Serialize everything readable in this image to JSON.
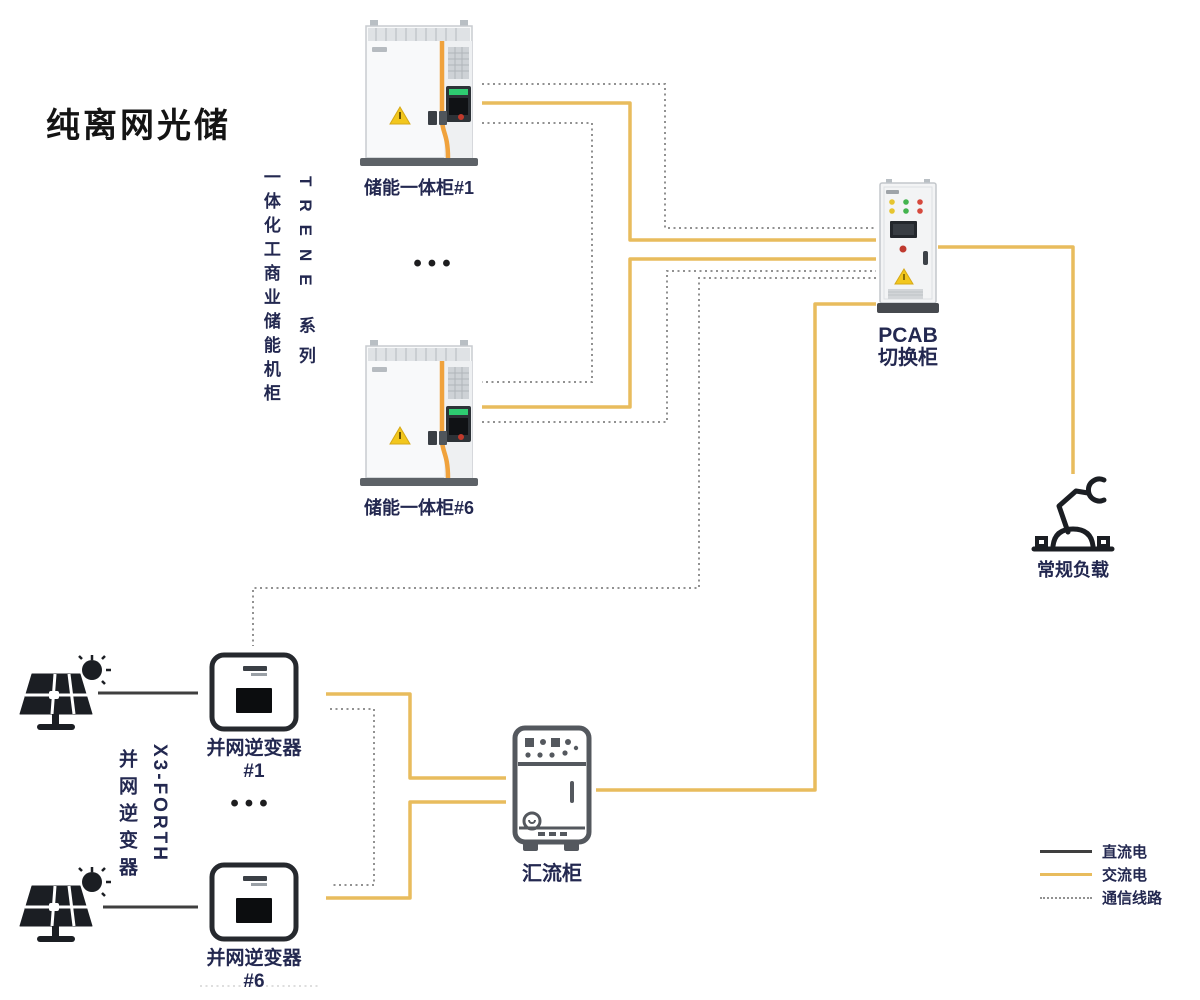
{
  "title": "纯离网光储",
  "storage_group": {
    "series_label_primary": "TRENE 系列",
    "series_label_secondary": "一体化工商业储能机柜",
    "cabinet_1_label": "储能一体柜#1",
    "cabinet_6_label": "储能一体柜#6",
    "more_units_ellipsis": "•••"
  },
  "pv_group": {
    "series_label_primary": "X3-FORTH",
    "series_label_secondary": "并网逆变器",
    "inverter_1_label": "并网逆变器#1",
    "inverter_6_label": "并网逆变器#6",
    "more_units_ellipsis": "•••"
  },
  "pcab": {
    "label_line1": "PCAB",
    "label_line2": "切换柜"
  },
  "load": {
    "label": "常规负载"
  },
  "combiner": {
    "label": "汇流柜"
  },
  "legend": {
    "items": [
      {
        "label": "直流电",
        "style": "solid",
        "color": "#3F3F3F"
      },
      {
        "label": "交流电",
        "style": "solid",
        "color": "#E8BC5D"
      },
      {
        "label": "通信线路",
        "style": "dotted",
        "color": "#919191"
      }
    ]
  },
  "icons": {
    "storage_cabinet": "battery-storage-cabinet-icon",
    "pcab_cabinet": "switchover-cabinet-icon",
    "combiner_cabinet": "combiner-cabinet-icon",
    "inverter": "grid-inverter-icon",
    "solar_panel": "solar-panel-sun-icon",
    "load": "robot-arm-icon"
  },
  "colors": {
    "dc_line": "#3F3F3F",
    "ac_line": "#E8BC5D",
    "comm_line": "#919191",
    "label_text": "#232850",
    "title_text": "#141414",
    "warning_triangle": "#F2C71D",
    "cabinet_stripe": "#F0A23C"
  }
}
